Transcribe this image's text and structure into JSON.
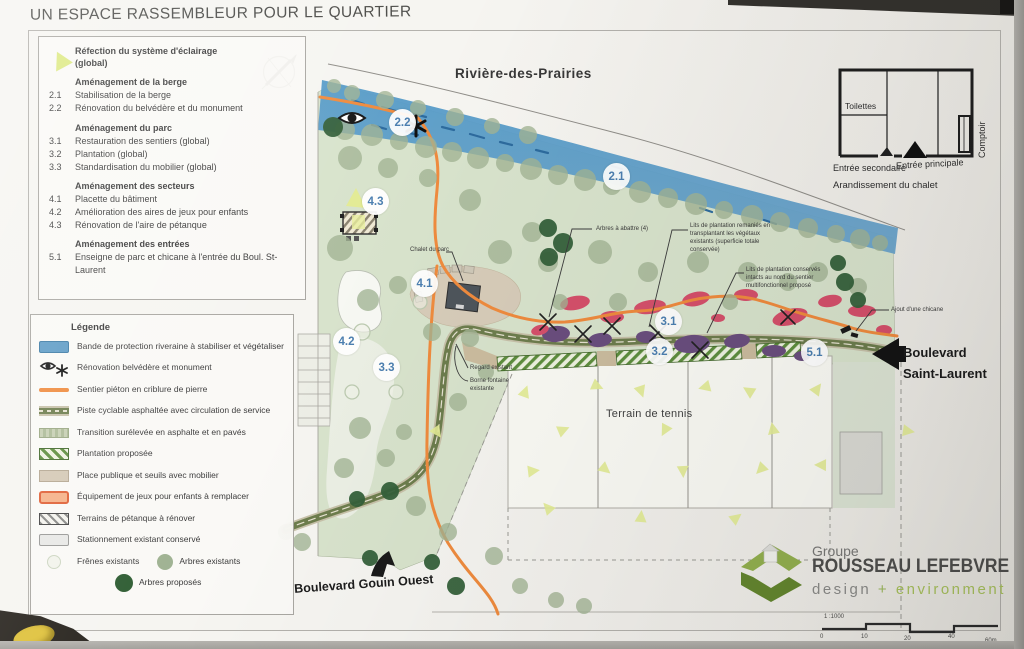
{
  "title": "UN ESPACE RASSEMBLEUR POUR LE QUARTIER",
  "program": {
    "lighting_label": "Réfection du système d'éclairage (global)",
    "sections": [
      {
        "heading": "Aménagement de la berge",
        "items": [
          {
            "num": "2.1",
            "label": "Stabilisation de la berge"
          },
          {
            "num": "2.2",
            "label": "Rénovation du belvédère et du monument"
          }
        ]
      },
      {
        "heading": "Aménagement du parc",
        "items": [
          {
            "num": "3.1",
            "label": "Restauration des sentiers (global)"
          },
          {
            "num": "3.2",
            "label": "Plantation (global)"
          },
          {
            "num": "3.3",
            "label": "Standardisation du mobilier (global)"
          }
        ]
      },
      {
        "heading": "Aménagement des secteurs",
        "items": [
          {
            "num": "4.1",
            "label": "Placette du bâtiment"
          },
          {
            "num": "4.2",
            "label": "Amélioration des aires de jeux pour enfants"
          },
          {
            "num": "4.3",
            "label": "Rénovation de l'aire de pétanque"
          }
        ]
      },
      {
        "heading": "Aménagement des entrées",
        "items": [
          {
            "num": "5.1",
            "label": "Enseigne de parc et chicane à l'entrée du Boul. St-Laurent"
          }
        ]
      }
    ]
  },
  "legend": {
    "title": "Légende",
    "items": [
      "Bande de protection riveraine à stabiliser et végétaliser",
      "Rénovation belvédère et monument",
      "Sentier piéton en criblure de pierre",
      "Piste cyclable asphaltée avec circulation de service",
      "Transition surélevée en asphalte et en pavés",
      "Plantation proposée",
      "Place publique et seuils avec mobilier",
      "Équipement de jeux pour enfants à remplacer",
      "Terrains de pétanque à rénover",
      "Stationnement existant conservé",
      "Frênes existants",
      "Arbres existants",
      "Arbres proposés"
    ]
  },
  "plan": {
    "river_label": "Rivière-des-Prairies",
    "tennis_label": "Terrain de tennis",
    "street_gouin": "Boulevard Gouin Ouest",
    "street_saint_laurent": "Boulevard Saint-Laurent",
    "markers": [
      "2.1",
      "2.2",
      "3.1",
      "3.2",
      "3.3",
      "4.1",
      "4.2",
      "4.3",
      "5.1"
    ],
    "callouts": {
      "chalet": "Chalet du parc",
      "trees_remove": "Arbres à abattre (4)",
      "beds_reworked": "Lits de plantation remaniés en transplantant les végétaux existants (superficie totale conservée)",
      "beds_kept": "Lits de plantation conservés intacts au nord du sentier multifonctionnel proposé",
      "chicane": "Ajout d'une chicane",
      "regard": "Regard existant",
      "borne": "Borne fontaine existante"
    }
  },
  "chalet_inset": {
    "caption": "Arandissement du chalet",
    "room_toilettes": "Toilettes",
    "room_comptoir": "Comptoir",
    "entrance_secondary": "Entrée secondaire",
    "entrance_main": "Entrée principale"
  },
  "firm": {
    "group": "Groupe",
    "name": "ROUSSEAU LEFEBVRE",
    "tagline_design": "design",
    "tagline_plus": "+",
    "tagline_env": "environment"
  },
  "scalebar": {
    "ratio": "1 :1000",
    "ticks": [
      "0",
      "10",
      "20",
      "40",
      "60m"
    ]
  },
  "colors": {
    "river": "#5f9cc6",
    "park": "#d8e3cc",
    "path_orange": "#ef8b3e",
    "bike_path": "#6d7d4d",
    "hatch_green": "#5e8e3e",
    "beds_red": "#d5506b",
    "beds_purple": "#6a4e7e",
    "tree_existing": "#a2b494",
    "tree_proposed": "#35603a",
    "marker_text": "#4c7fb0",
    "logo_green": "#93b04f"
  }
}
